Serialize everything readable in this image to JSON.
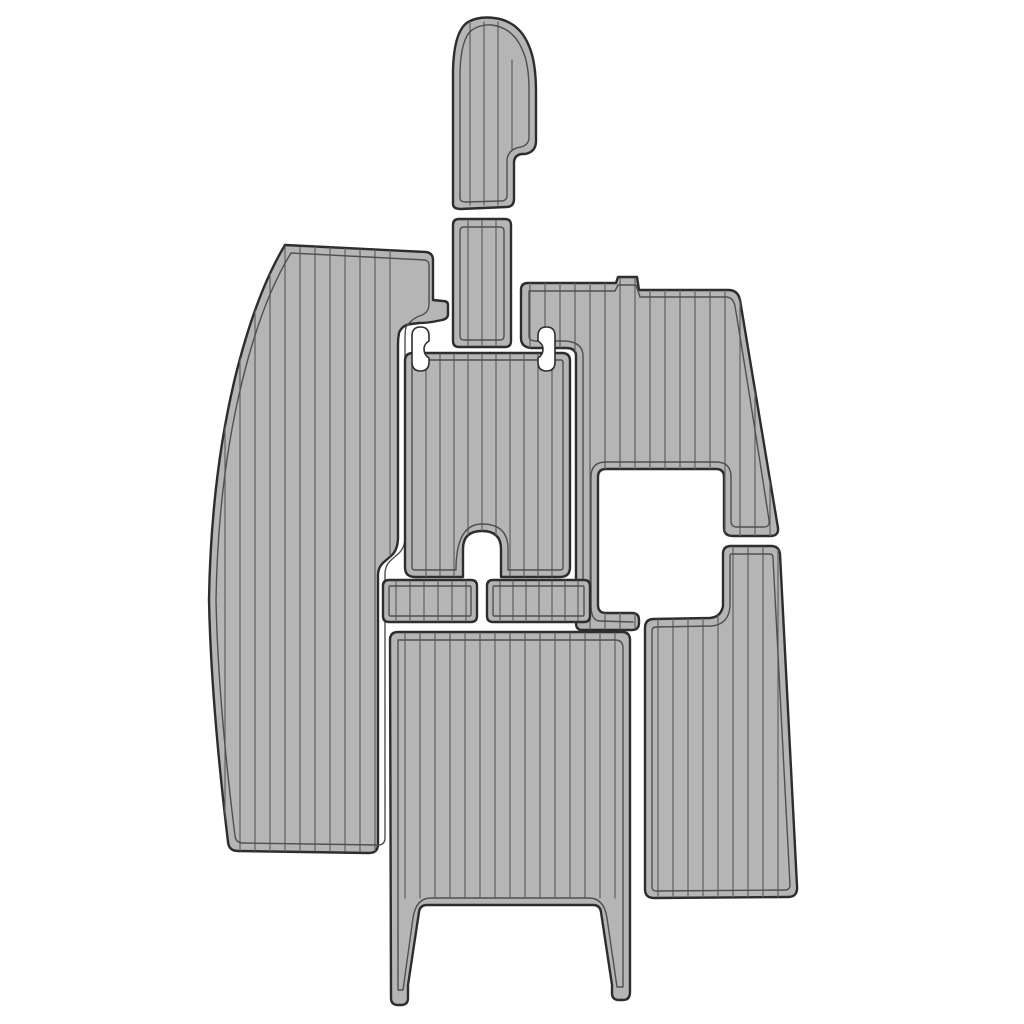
{
  "canvas": {
    "width": 1024,
    "height": 1024,
    "background": "#ffffff"
  },
  "colors": {
    "pad_fill": "#b5b5b5",
    "outline": "#2d2d2d",
    "groove": "#4f4f4f",
    "plank": "#616161",
    "cutout_fill": "#ffffff"
  },
  "stroke_widths": {
    "outline": 2.4,
    "groove": 1.4,
    "plank": 1.2
  },
  "pieces": [
    {
      "name": "port-side-pad",
      "outer": "M 285,245 L 426,252 Q 433,253 433,260 L 433,300 L 443,301 Q 448,301 448,305 L 448,314 Q 448,319 442,320 L 437,321 Q 428,323 419,323 L 411,324 Q 402,325 399,333 Q 398,338 398,344 L 398,537 Q 398,550 391,556 L 384,562 Q 378,567 378,575 L 378,844 Q 378,853 369,853 L 238,851 Q 229,851 228,842 Q 211,700 209,600 Q 211,478 235,378 Q 256,293 285,245 Z",
      "grooves": [
        "M 291,253 L 425,260 Q 429,261 429,265 L 429,304 Q 429,312 422,315 Q 412,318 406,327 Q 405,331 405,340 L 405,537 Q 405,548 398,554 L 390,561 Q 385,566 385,574 L 385,838 Q 385,845 378,845 L 243,843 Q 236,843 235,836 Q 218,700 216,600 Q 218,480 242,382 Q 262,300 291,253 Z"
      ],
      "planks": [
        {
          "x1": 225,
          "x2": 390,
          "step": 15,
          "y1": 247,
          "y2": 851
        }
      ]
    },
    {
      "name": "bow-console-pad",
      "outer": "M 453,204 L 453,70 Q 454,31 468,22 Q 479,16 494,18 Q 519,21 529,46 Q 536,62 536,92 L 536,141 Q 536,152 525,154 L 522,154 Q 514,155 514,163 L 514,199 Q 514,207 506,207 L 461,209 Q 453,209 453,204 Z",
      "grooves": [
        "M 460,198 L 460,72 Q 461,38 472,30 Q 481,24 492,25 Q 513,28 522,49 Q 529,63 529,90 L 529,137 Q 529,145 521,147 Q 508,149 507,160 L 507,195 Q 507,201 501,201 L 466,202 Q 460,202 460,198 Z"
      ],
      "planks": [
        {
          "x1": 470,
          "x2": 498,
          "step": 14,
          "y1": 22,
          "y2": 205
        },
        {
          "x1": 512,
          "x2": 512,
          "step": 14,
          "y1": 60,
          "y2": 150
        }
      ]
    },
    {
      "name": "spacer-strip-pad",
      "outer": "M 459,219 L 505,219 Q 511,219 511,225 L 511,341 Q 511,347 505,347 L 459,347 Q 453,347 453,341 L 453,225 Q 453,219 459,219 Z",
      "grooves": [
        "M 464,227 L 500,227 Q 504,227 504,231 L 504,336 Q 504,340 500,340 L 464,340 Q 460,340 460,336 L 460,231 Q 460,227 464,227 Z"
      ],
      "planks": [
        {
          "x1": 468,
          "x2": 496,
          "step": 14,
          "y1": 221,
          "y2": 345
        }
      ]
    },
    {
      "name": "starboard-top-pad",
      "outer": "M 528,283 L 616,283 L 618,277 L 637,277 L 639,290 L 728,290 Q 738,290 740,300 Q 757,404 778,528 Q 779,536 770,536 L 733,536 Q 724,536 724,528 L 724,477 Q 724,469 716,469 L 606,469 Q 598,469 598,477 L 598,605 Q 598,613 606,613 L 632,613 Q 639,613 639,620 L 639,623 Q 639,630 632,630 L 582,630 Q 576,630 576,623 L 576,356 Q 576,348 566,348 L 531,348 Q 521,347 521,338 L 521,290 Q 521,283 528,283 Z",
      "grooves": [
        "M 529,291 L 615,291 L 618,285 L 636,285 L 640,297 L 726,297 Q 733,297 735,306 Q 751,403 769,520 Q 770,527 764,527 L 737,527 Q 731,527 731,521 L 731,477 Q 731,462 716,462 L 606,462 Q 591,462 591,477 L 591,605 Q 591,621 600,621 L 633,622",
        "M 529,292 L 529,336 Q 529,341 536,341 L 565,341 Q 583,342 583,356 L 583,620"
      ],
      "planks": [
        {
          "x1": 530,
          "x2": 770,
          "step": 15,
          "y1": 278,
          "y2": 629
        }
      ]
    },
    {
      "name": "starboard-bottom-pad",
      "outer": "M 731,546 L 771,546 Q 779,546 780,554 L 797,886 Q 798,897 788,897 L 654,898 Q 645,898 645,889 L 645,628 Q 645,619 654,619 L 710,618 Q 721,617 723,606 L 723,554 Q 723,546 731,546 Z",
      "grooves": [
        "M 731,554 L 770,554 Q 773,554 773,558 L 790,885 Q 790,890 785,890 L 656,891 Q 652,891 652,887 L 652,631 Q 652,627 656,627 L 712,626 Q 729,624 730,606 L 730,557 Q 730,554 731,554 Z"
      ],
      "planks": [
        {
          "x1": 658,
          "x2": 788,
          "step": 15,
          "y1": 547,
          "y2": 897
        }
      ]
    },
    {
      "name": "center-keyhole-pad",
      "outer": "M 413,353 L 562,353 Q 570,353 570,361 L 570,567 Q 570,577 560,577 L 501,577 L 501,549 Q 501,531 482,531 Q 463,531 463,549 L 463,577 L 415,577 Q 405,577 405,567 L 405,361 Q 405,353 413,353 Z",
      "grooves": [
        "M 414,360 L 561,360 Q 563,360 563,363 L 563,567 Q 563,570 560,570 L 508,570 L 508,549 Q 508,524 482,524 Q 456,524 456,570 L 456,570 L 415,570 Q 412,570 412,567 L 412,363 Q 412,360 414,360 Z"
      ],
      "planks": [
        {
          "x1": 426,
          "x2": 552,
          "step": 14,
          "y1": 354,
          "y2": 576
        }
      ]
    },
    {
      "name": "left-tab-pad",
      "outer": "M 389,580 L 471,580 Q 477,580 477,586 L 477,616 Q 477,622 471,622 L 389,622 Q 383,622 383,616 L 383,586 Q 383,580 389,580 Z",
      "grooves": [
        "M 390,586 L 470,586 Q 471,586 471,588 L 471,614 Q 471,616 470,616 L 390,616 Q 389,616 389,614 L 389,588 Q 389,586 390,586 Z"
      ],
      "planks": [
        {
          "x1": 396,
          "x2": 466,
          "step": 14,
          "y1": 581,
          "y2": 621
        }
      ]
    },
    {
      "name": "right-tab-pad",
      "outer": "M 493,580 L 584,580 Q 590,580 590,586 L 590,616 Q 590,622 584,622 L 493,622 Q 487,622 487,616 L 487,586 Q 487,580 493,580 Z",
      "grooves": [
        "M 494,586 L 583,586 Q 584,586 584,588 L 584,614 Q 584,616 583,616 L 494,616 Q 493,616 493,614 L 493,588 Q 493,586 494,586 Z"
      ],
      "planks": [
        {
          "x1": 500,
          "x2": 578,
          "step": 13,
          "y1": 581,
          "y2": 621
        }
      ]
    },
    {
      "name": "stern-seat-pad",
      "outer": "M 398,632 L 622,632 Q 630,632 630,640 L 630,992 Q 630,1000 623,1000 L 619,1000 Q 612,1000 612,993 L 612,985 L 601,912 Q 600,905 593,905 L 427,905 Q 420,905 419,912 L 408,985 L 408,998 Q 408,1005 401,1005 L 398,1005 Q 391,1005 391,998 L 390,640 Q 390,632 398,632 Z",
      "grooves": [
        "M 398,640 L 615,640 Q 623,640 623,648 L 623,987 L 617,987 L 607,918 Q 604,898 589,898 L 431,898 Q 416,898 413,918 L 403,990 L 398,990 Z"
      ],
      "planks": [
        {
          "x1": 405,
          "x2": 615,
          "step": 15,
          "y1": 633,
          "y2": 898
        }
      ]
    }
  ],
  "cutouts": [
    {
      "name": "dumbbell-cutout-left",
      "path": "M 412,336 Q 412,327 420.5,327 Q 429,327 429,336 L 429,341 Q 424,344 424,349 Q 424,355 429,358 L 429,362 Q 429,371 420.5,371 Q 412,371 412,362 Z"
    },
    {
      "name": "dumbbell-cutout-right",
      "path": "M 555,336 Q 555,327 546.5,327 Q 538,327 538,336 L 538,341 Q 543,344 543,349 Q 543,355 538,358 L 538,362 Q 538,371 546.5,371 Q 555,371 555,362 Z"
    }
  ]
}
